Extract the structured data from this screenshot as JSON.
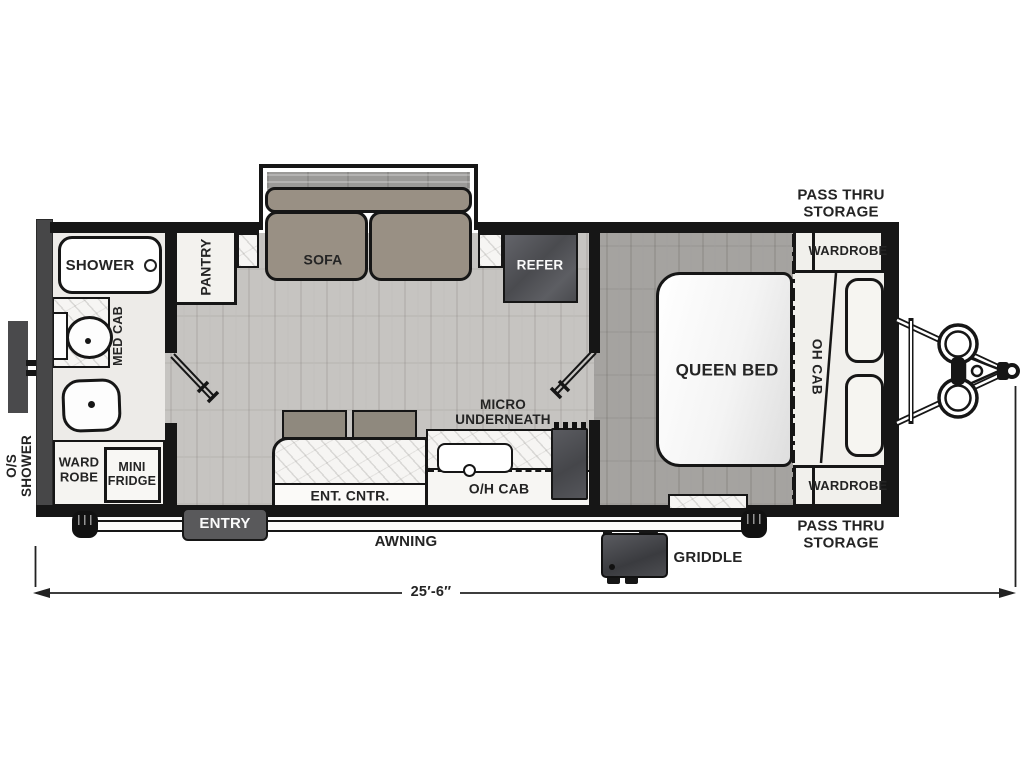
{
  "floorplan": {
    "rear_exterior": {
      "os_shower_line1": "O/S",
      "os_shower_line2": "SHOWER"
    },
    "bathroom": {
      "shower": "SHOWER",
      "med_cab": "MED CAB",
      "wardrobe_line1": "WARD",
      "wardrobe_line2": "ROBE",
      "mini_fridge_line1": "MINI",
      "mini_fridge_line2": "FRIDGE"
    },
    "living": {
      "pantry": "PANTRY",
      "sofa": "SOFA",
      "refer": "REFER",
      "ent_cntr": "ENT. CNTR.",
      "micro_line1": "MICRO",
      "micro_line2": "UNDERNEATH",
      "oh_cab": "O/H CAB"
    },
    "bedroom": {
      "queen_bed": "QUEEN BED",
      "oh_cab": "OH CAB",
      "wardrobe_top": "WARDROBE",
      "wardrobe_bottom": "WARDROBE"
    },
    "front_storage": {
      "pass_thru_line1": "PASS THRU",
      "pass_thru_line2": "STORAGE"
    },
    "exterior": {
      "entry": "ENTRY",
      "awning": "AWNING",
      "griddle": "GRIDDLE"
    },
    "dimensions": {
      "overall_length": "25′-6″"
    }
  },
  "colors": {
    "wall": "#161616",
    "rear_wall": "#474748",
    "floor_living": "#c6c4c1",
    "floor_bedroom": "#a5a3a0",
    "upholstery": "#999084",
    "appliance_dark": "#4e4f52",
    "marble": "#f6f5f3",
    "storage_cream": "#f1f0ec",
    "badge_gray": "#59595b"
  }
}
